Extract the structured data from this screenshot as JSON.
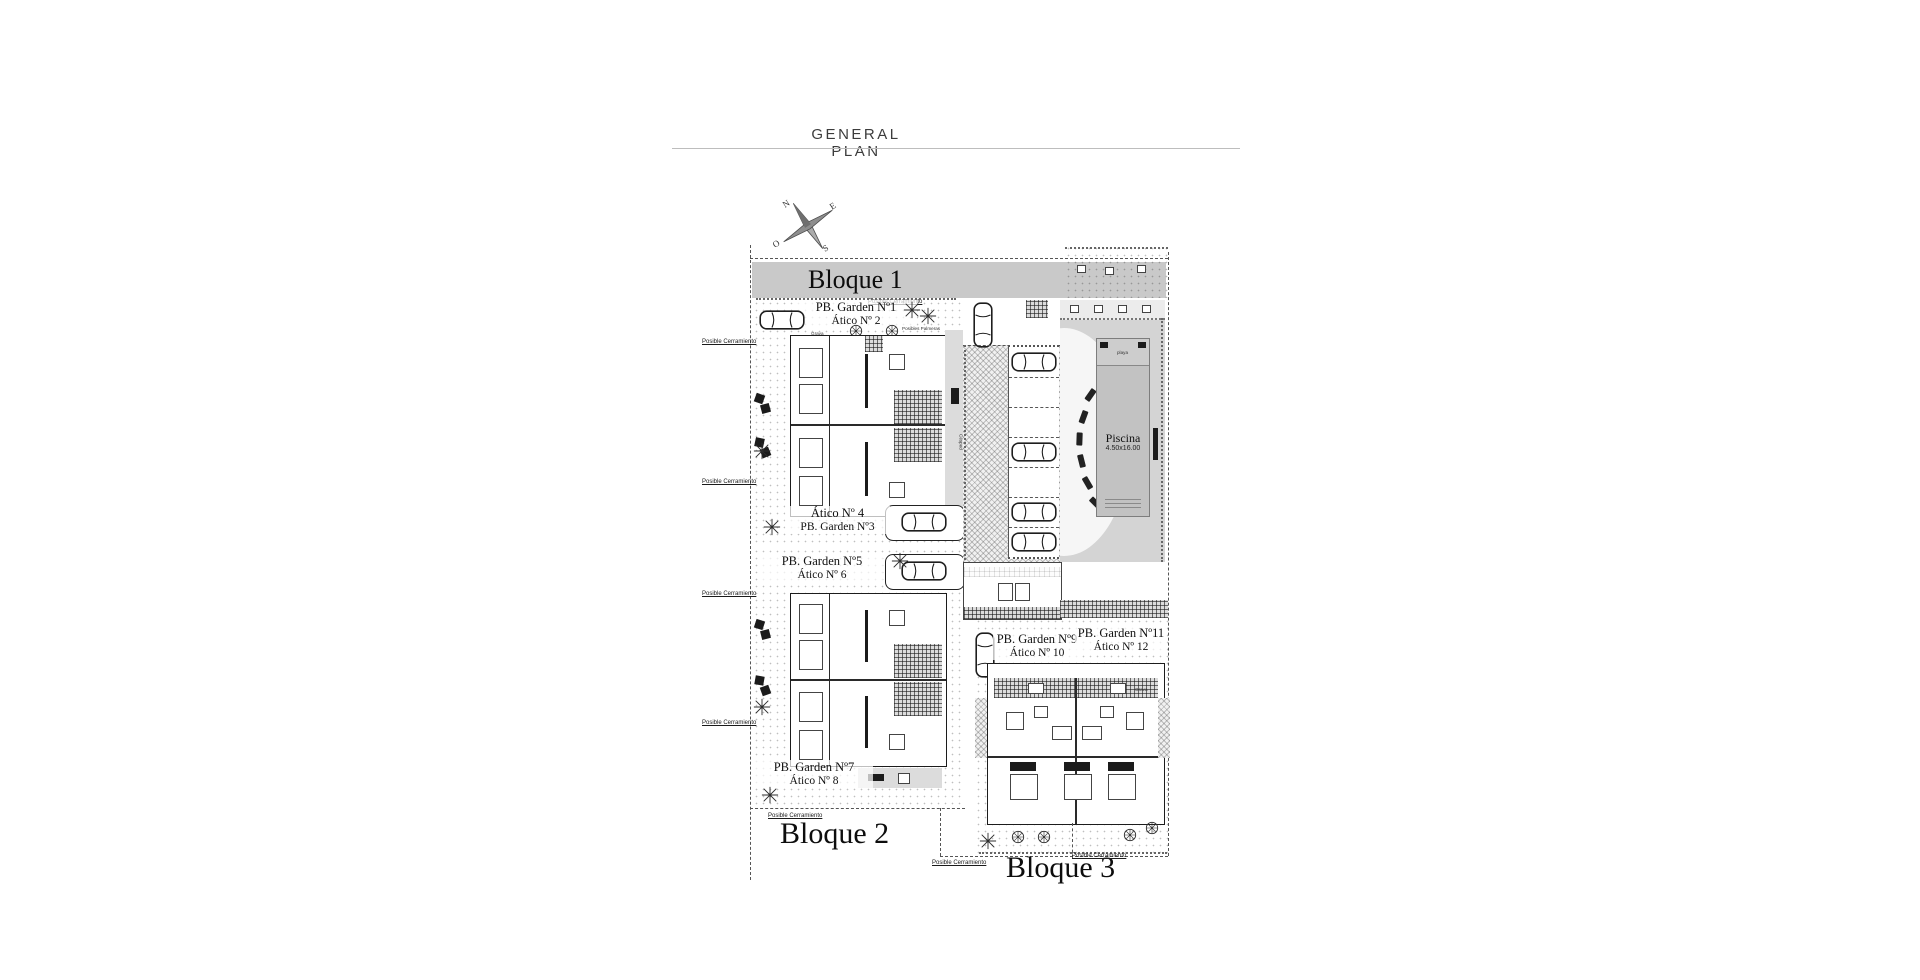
{
  "page": {
    "title": "GENERAL PLAN"
  },
  "compass": {
    "n": "N",
    "e": "E",
    "s": "S",
    "o": "O"
  },
  "blocks": {
    "b1": "Bloque 1",
    "b2": "Bloque 2",
    "b3": "Bloque 3"
  },
  "units": {
    "u12": {
      "line1": "PB. Garden Nº1",
      "line2": "Ático Nº 2"
    },
    "u34": {
      "line1": "Ático Nº 4",
      "line2": "PB. Garden Nº3"
    },
    "u56": {
      "line1": "PB. Garden Nº5",
      "line2": "Ático Nº 6"
    },
    "u78": {
      "line1": "PB. Garden Nº7",
      "line2": "Ático Nº 8"
    },
    "u910": {
      "line1": "PB. Garden Nº9",
      "line2": "Ático Nº 10"
    },
    "u1112": {
      "line1": "PB. Garden Nº11",
      "line2": "Ático Nº 12"
    }
  },
  "pool": {
    "name": "Piscina",
    "dims": "4.50x16.00",
    "beach_label": "playa"
  },
  "annotations": {
    "posible_cerramiento": "Posible Cerramiento",
    "posibles_palmeras": "Posibles Palmeras",
    "posible_naranjo": "Posible Naranjo",
    "posible_limonero": "Posible Limonero",
    "cesped": "Césped",
    "grava": "Grava"
  },
  "colors": {
    "page_bg": "#ffffff",
    "banner_gray": "#c9c9c9",
    "pool_deck": "#d4d4d4",
    "pool_water": "#c2c2c2",
    "ink": "#1c1c1c"
  }
}
